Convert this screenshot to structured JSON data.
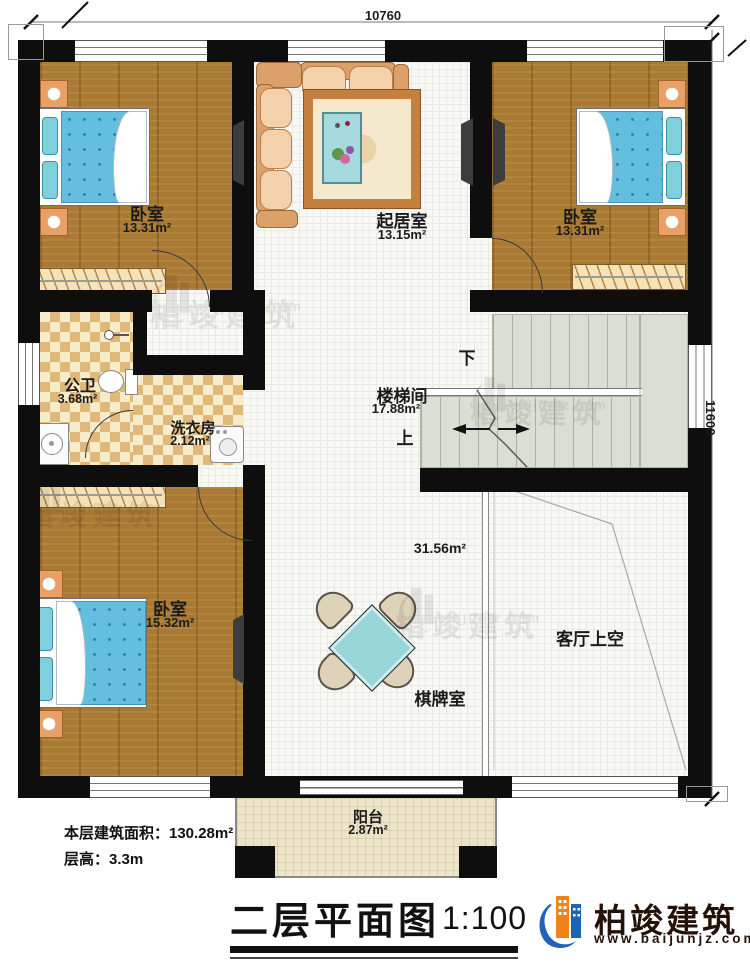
{
  "dims": {
    "top": "10760",
    "right": "11600"
  },
  "rooms": {
    "bedroom_tl": {
      "name": "卧室",
      "area": "13.31m²"
    },
    "living": {
      "name": "起居室",
      "area": "13.15m²"
    },
    "bedroom_tr": {
      "name": "卧室",
      "area": "13.31m²"
    },
    "bathroom": {
      "name": "公卫",
      "area": "3.68m²"
    },
    "laundry": {
      "name": "洗衣房",
      "area": "2.12m²"
    },
    "stairs": {
      "name": "楼梯间",
      "area": "17.88m²",
      "up": "上",
      "down": "下"
    },
    "bedroom_bl": {
      "name": "卧室",
      "area": "15.32m²"
    },
    "game": {
      "name": "棋牌室",
      "area": "31.56m²"
    },
    "void": {
      "name": "客厅上空"
    },
    "balcony": {
      "name": "阳台",
      "area": "2.87m²"
    }
  },
  "footer": {
    "area_line": "本层建筑面积：130.28m²",
    "height_line": "层高：3.3m",
    "title": "二层平面图",
    "scale": "1:100"
  },
  "brand": {
    "name": "柏竣建筑",
    "url": "www.baijunjz.com"
  },
  "watermark": {
    "name": "柏竣建筑",
    "url": "www.baijunjz.com"
  },
  "colors": {
    "wall": "#0e0e0e",
    "wood": "#a97a33",
    "checker": "#dfb87a",
    "stairs": "#d9dfd4",
    "bed": "#64bede",
    "table": "#97d5d8",
    "brand_blue": "#1e63b5",
    "brand_orange": "#ef8318"
  }
}
